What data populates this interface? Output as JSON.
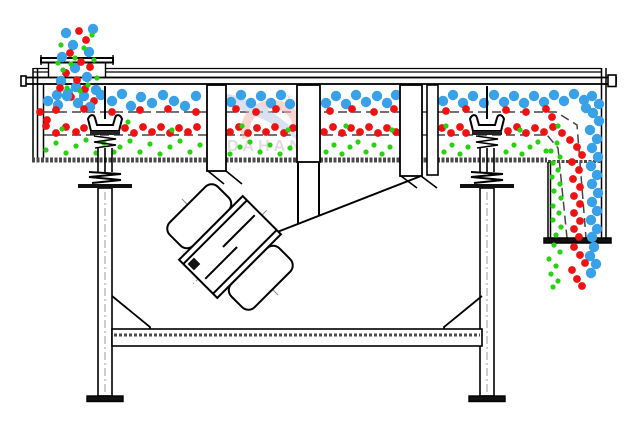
{
  "watermark": {
    "brand": "DAHAN",
    "registered": "®"
  },
  "colors": {
    "blue": "#38a1e8",
    "red": "#ee1212",
    "green": "#27d30f",
    "line": "#000000",
    "speckle_band": "#4a4a4a",
    "centerline": "#999999",
    "watermark_text": "#c2c2c2",
    "watermark_pink": "#f3b3a7",
    "watermark_blue": "#b9c9e3"
  },
  "particles": {
    "radius": {
      "blue": 5.2,
      "red": 3.9,
      "green": 2.6
    },
    "groups": [
      {
        "name": "feed-stream-blue",
        "color": "blue",
        "points": [
          [
            66,
            33
          ],
          [
            73,
            45
          ],
          [
            89,
            52
          ],
          [
            62,
            57
          ],
          [
            75,
            68
          ],
          [
            87,
            77
          ],
          [
            61,
            81
          ],
          [
            76,
            87
          ],
          [
            93,
            29
          ],
          [
            68,
            93
          ],
          [
            84,
            96
          ],
          [
            57,
            95
          ],
          [
            96,
            90
          ]
        ]
      },
      {
        "name": "feed-stream-red",
        "color": "red",
        "points": [
          [
            79,
            31
          ],
          [
            86,
            40
          ],
          [
            70,
            53
          ],
          [
            81,
            62
          ],
          [
            66,
            73
          ],
          [
            90,
            67
          ],
          [
            77,
            80
          ],
          [
            85,
            89
          ],
          [
            60,
            88
          ],
          [
            71,
            97
          ],
          [
            94,
            101
          ]
        ]
      },
      {
        "name": "feed-stream-green",
        "color": "green",
        "points": [
          [
            92,
            35
          ],
          [
            61,
            45
          ],
          [
            84,
            48
          ],
          [
            94,
            60
          ],
          [
            71,
            64
          ],
          [
            63,
            70
          ],
          [
            88,
            85
          ],
          [
            75,
            58
          ],
          [
            97,
            78
          ],
          [
            58,
            63
          ],
          [
            80,
            91
          ],
          [
            67,
            88
          ]
        ]
      },
      {
        "name": "top-deck-oversize-blue",
        "color": "blue",
        "points": [
          [
            48,
            101
          ],
          [
            58,
            105
          ],
          [
            67,
            96
          ],
          [
            78,
            103
          ],
          [
            90,
            107
          ],
          [
            101,
            95
          ],
          [
            112,
            101
          ],
          [
            122,
            94
          ],
          [
            131,
            106
          ],
          [
            141,
            97
          ],
          [
            152,
            103
          ],
          [
            163,
            95
          ],
          [
            174,
            101
          ],
          [
            185,
            106
          ],
          [
            196,
            96
          ],
          [
            231,
            102
          ],
          [
            241,
            95
          ],
          [
            251,
            103
          ],
          [
            261,
            96
          ],
          [
            271,
            103
          ],
          [
            281,
            95
          ],
          [
            290,
            104
          ],
          [
            326,
            103
          ],
          [
            336,
            96
          ],
          [
            346,
            104
          ],
          [
            356,
            95
          ],
          [
            366,
            102
          ],
          [
            377,
            96
          ],
          [
            387,
            103
          ],
          [
            396,
            95
          ],
          [
            443,
            101
          ],
          [
            453,
            95
          ],
          [
            463,
            103
          ],
          [
            473,
            96
          ],
          [
            484,
            103
          ],
          [
            494,
            95
          ],
          [
            504,
            102
          ],
          [
            514,
            96
          ],
          [
            524,
            103
          ],
          [
            534,
            96
          ],
          [
            544,
            102
          ],
          [
            554,
            95
          ],
          [
            564,
            101
          ],
          [
            574,
            94
          ],
          [
            584,
            100
          ],
          [
            592,
            96
          ],
          [
            599,
            104
          ],
          [
            586,
            108
          ]
        ]
      },
      {
        "name": "discharge-curve-blue",
        "color": "blue",
        "points": [
          [
            593,
            113
          ],
          [
            599,
            121
          ],
          [
            590,
            130
          ],
          [
            597,
            139
          ],
          [
            592,
            148
          ],
          [
            598,
            157
          ],
          [
            591,
            166
          ],
          [
            597,
            175
          ],
          [
            592,
            184
          ],
          [
            598,
            193
          ],
          [
            592,
            202
          ],
          [
            597,
            211
          ],
          [
            591,
            220
          ],
          [
            597,
            229
          ],
          [
            592,
            237
          ],
          [
            594,
            247
          ],
          [
            590,
            256
          ],
          [
            596,
            264
          ],
          [
            591,
            273
          ]
        ]
      },
      {
        "name": "middle-deck-red",
        "color": "red",
        "points": [
          [
            40,
            112
          ],
          [
            47,
            120
          ],
          [
            56,
            110
          ],
          [
            84,
            109
          ],
          [
            112,
            112
          ],
          [
            140,
            110
          ],
          [
            168,
            109
          ],
          [
            196,
            112
          ],
          [
            236,
            109
          ],
          [
            256,
            112
          ],
          [
            276,
            109
          ],
          [
            330,
            111
          ],
          [
            352,
            109
          ],
          [
            374,
            112
          ],
          [
            394,
            109
          ],
          [
            446,
            111
          ],
          [
            466,
            109
          ],
          [
            506,
            110
          ],
          [
            526,
            112
          ],
          [
            546,
            109
          ],
          [
            552,
            117
          ],
          [
            46,
            126
          ],
          [
            56,
            133
          ],
          [
            66,
            127
          ],
          [
            76,
            132
          ],
          [
            84,
            128
          ],
          [
            125,
            128
          ],
          [
            134,
            133
          ],
          [
            143,
            127
          ],
          [
            152,
            132
          ],
          [
            161,
            127
          ],
          [
            170,
            133
          ],
          [
            179,
            128
          ],
          [
            188,
            132
          ],
          [
            197,
            127
          ],
          [
            230,
            132
          ],
          [
            239,
            127
          ],
          [
            248,
            133
          ],
          [
            257,
            128
          ],
          [
            266,
            132
          ],
          [
            275,
            127
          ],
          [
            284,
            133
          ],
          [
            293,
            128
          ],
          [
            324,
            132
          ],
          [
            333,
            127
          ],
          [
            342,
            133
          ],
          [
            351,
            128
          ],
          [
            360,
            132
          ],
          [
            369,
            127
          ],
          [
            378,
            133
          ],
          [
            387,
            128
          ],
          [
            396,
            132
          ],
          [
            442,
            128
          ],
          [
            451,
            133
          ],
          [
            460,
            127
          ],
          [
            466,
            133
          ],
          [
            508,
            131
          ],
          [
            517,
            127
          ],
          [
            526,
            133
          ],
          [
            535,
            128
          ],
          [
            544,
            132
          ],
          [
            553,
            127
          ]
        ]
      },
      {
        "name": "discharge-column-red",
        "color": "red",
        "points": [
          [
            562,
            133
          ],
          [
            570,
            140
          ],
          [
            577,
            147
          ],
          [
            582,
            155
          ],
          [
            572,
            162
          ],
          [
            579,
            170
          ],
          [
            573,
            179
          ],
          [
            580,
            187
          ],
          [
            574,
            196
          ],
          [
            580,
            204
          ],
          [
            574,
            213
          ],
          [
            580,
            221
          ],
          [
            574,
            229
          ],
          [
            579,
            237
          ],
          [
            574,
            247
          ],
          [
            580,
            255
          ],
          [
            585,
            263
          ],
          [
            572,
            270
          ],
          [
            577,
            279
          ],
          [
            582,
            286
          ]
        ]
      },
      {
        "name": "middle-deck-green",
        "color": "green",
        "points": [
          [
            62,
            129
          ],
          [
            118,
            126
          ],
          [
            128,
            122
          ],
          [
            172,
            130
          ],
          [
            242,
            126
          ],
          [
            288,
            130
          ],
          [
            346,
            126
          ],
          [
            392,
            130
          ],
          [
            446,
            126
          ],
          [
            520,
            130
          ],
          [
            558,
            126
          ]
        ]
      },
      {
        "name": "bottom-deck-fines-green",
        "color": "green",
        "points": [
          [
            46,
            150
          ],
          [
            56,
            143
          ],
          [
            66,
            153
          ],
          [
            76,
            146
          ],
          [
            86,
            140
          ],
          [
            96,
            153
          ],
          [
            104,
            143
          ],
          [
            114,
            152
          ],
          [
            120,
            147
          ],
          [
            130,
            141
          ],
          [
            140,
            152
          ],
          [
            150,
            144
          ],
          [
            160,
            154
          ],
          [
            170,
            147
          ],
          [
            180,
            141
          ],
          [
            190,
            152
          ],
          [
            200,
            145
          ],
          [
            230,
            154
          ],
          [
            240,
            147
          ],
          [
            250,
            142
          ],
          [
            260,
            152
          ],
          [
            270,
            145
          ],
          [
            280,
            154
          ],
          [
            290,
            148
          ],
          [
            326,
            152
          ],
          [
            334,
            145
          ],
          [
            342,
            154
          ],
          [
            350,
            147
          ],
          [
            358,
            142
          ],
          [
            366,
            152
          ],
          [
            374,
            145
          ],
          [
            382,
            154
          ],
          [
            390,
            147
          ],
          [
            444,
            152
          ],
          [
            452,
            145
          ],
          [
            460,
            154
          ],
          [
            468,
            147
          ],
          [
            506,
            152
          ],
          [
            514,
            145
          ],
          [
            522,
            154
          ],
          [
            530,
            147
          ],
          [
            538,
            142
          ],
          [
            546,
            151
          ]
        ]
      },
      {
        "name": "discharge-column-green",
        "color": "green",
        "points": [
          [
            557,
            143
          ],
          [
            551,
            151
          ],
          [
            560,
            157
          ],
          [
            553,
            163
          ],
          [
            558,
            170
          ],
          [
            552,
            177
          ],
          [
            560,
            184
          ],
          [
            554,
            191
          ],
          [
            561,
            198
          ],
          [
            553,
            206
          ],
          [
            559,
            213
          ],
          [
            553,
            220
          ],
          [
            561,
            227
          ],
          [
            556,
            235
          ],
          [
            554,
            245
          ],
          [
            560,
            252
          ],
          [
            549,
            259
          ],
          [
            556,
            266
          ],
          [
            551,
            274
          ],
          [
            558,
            281
          ],
          [
            553,
            287
          ]
        ]
      }
    ]
  }
}
